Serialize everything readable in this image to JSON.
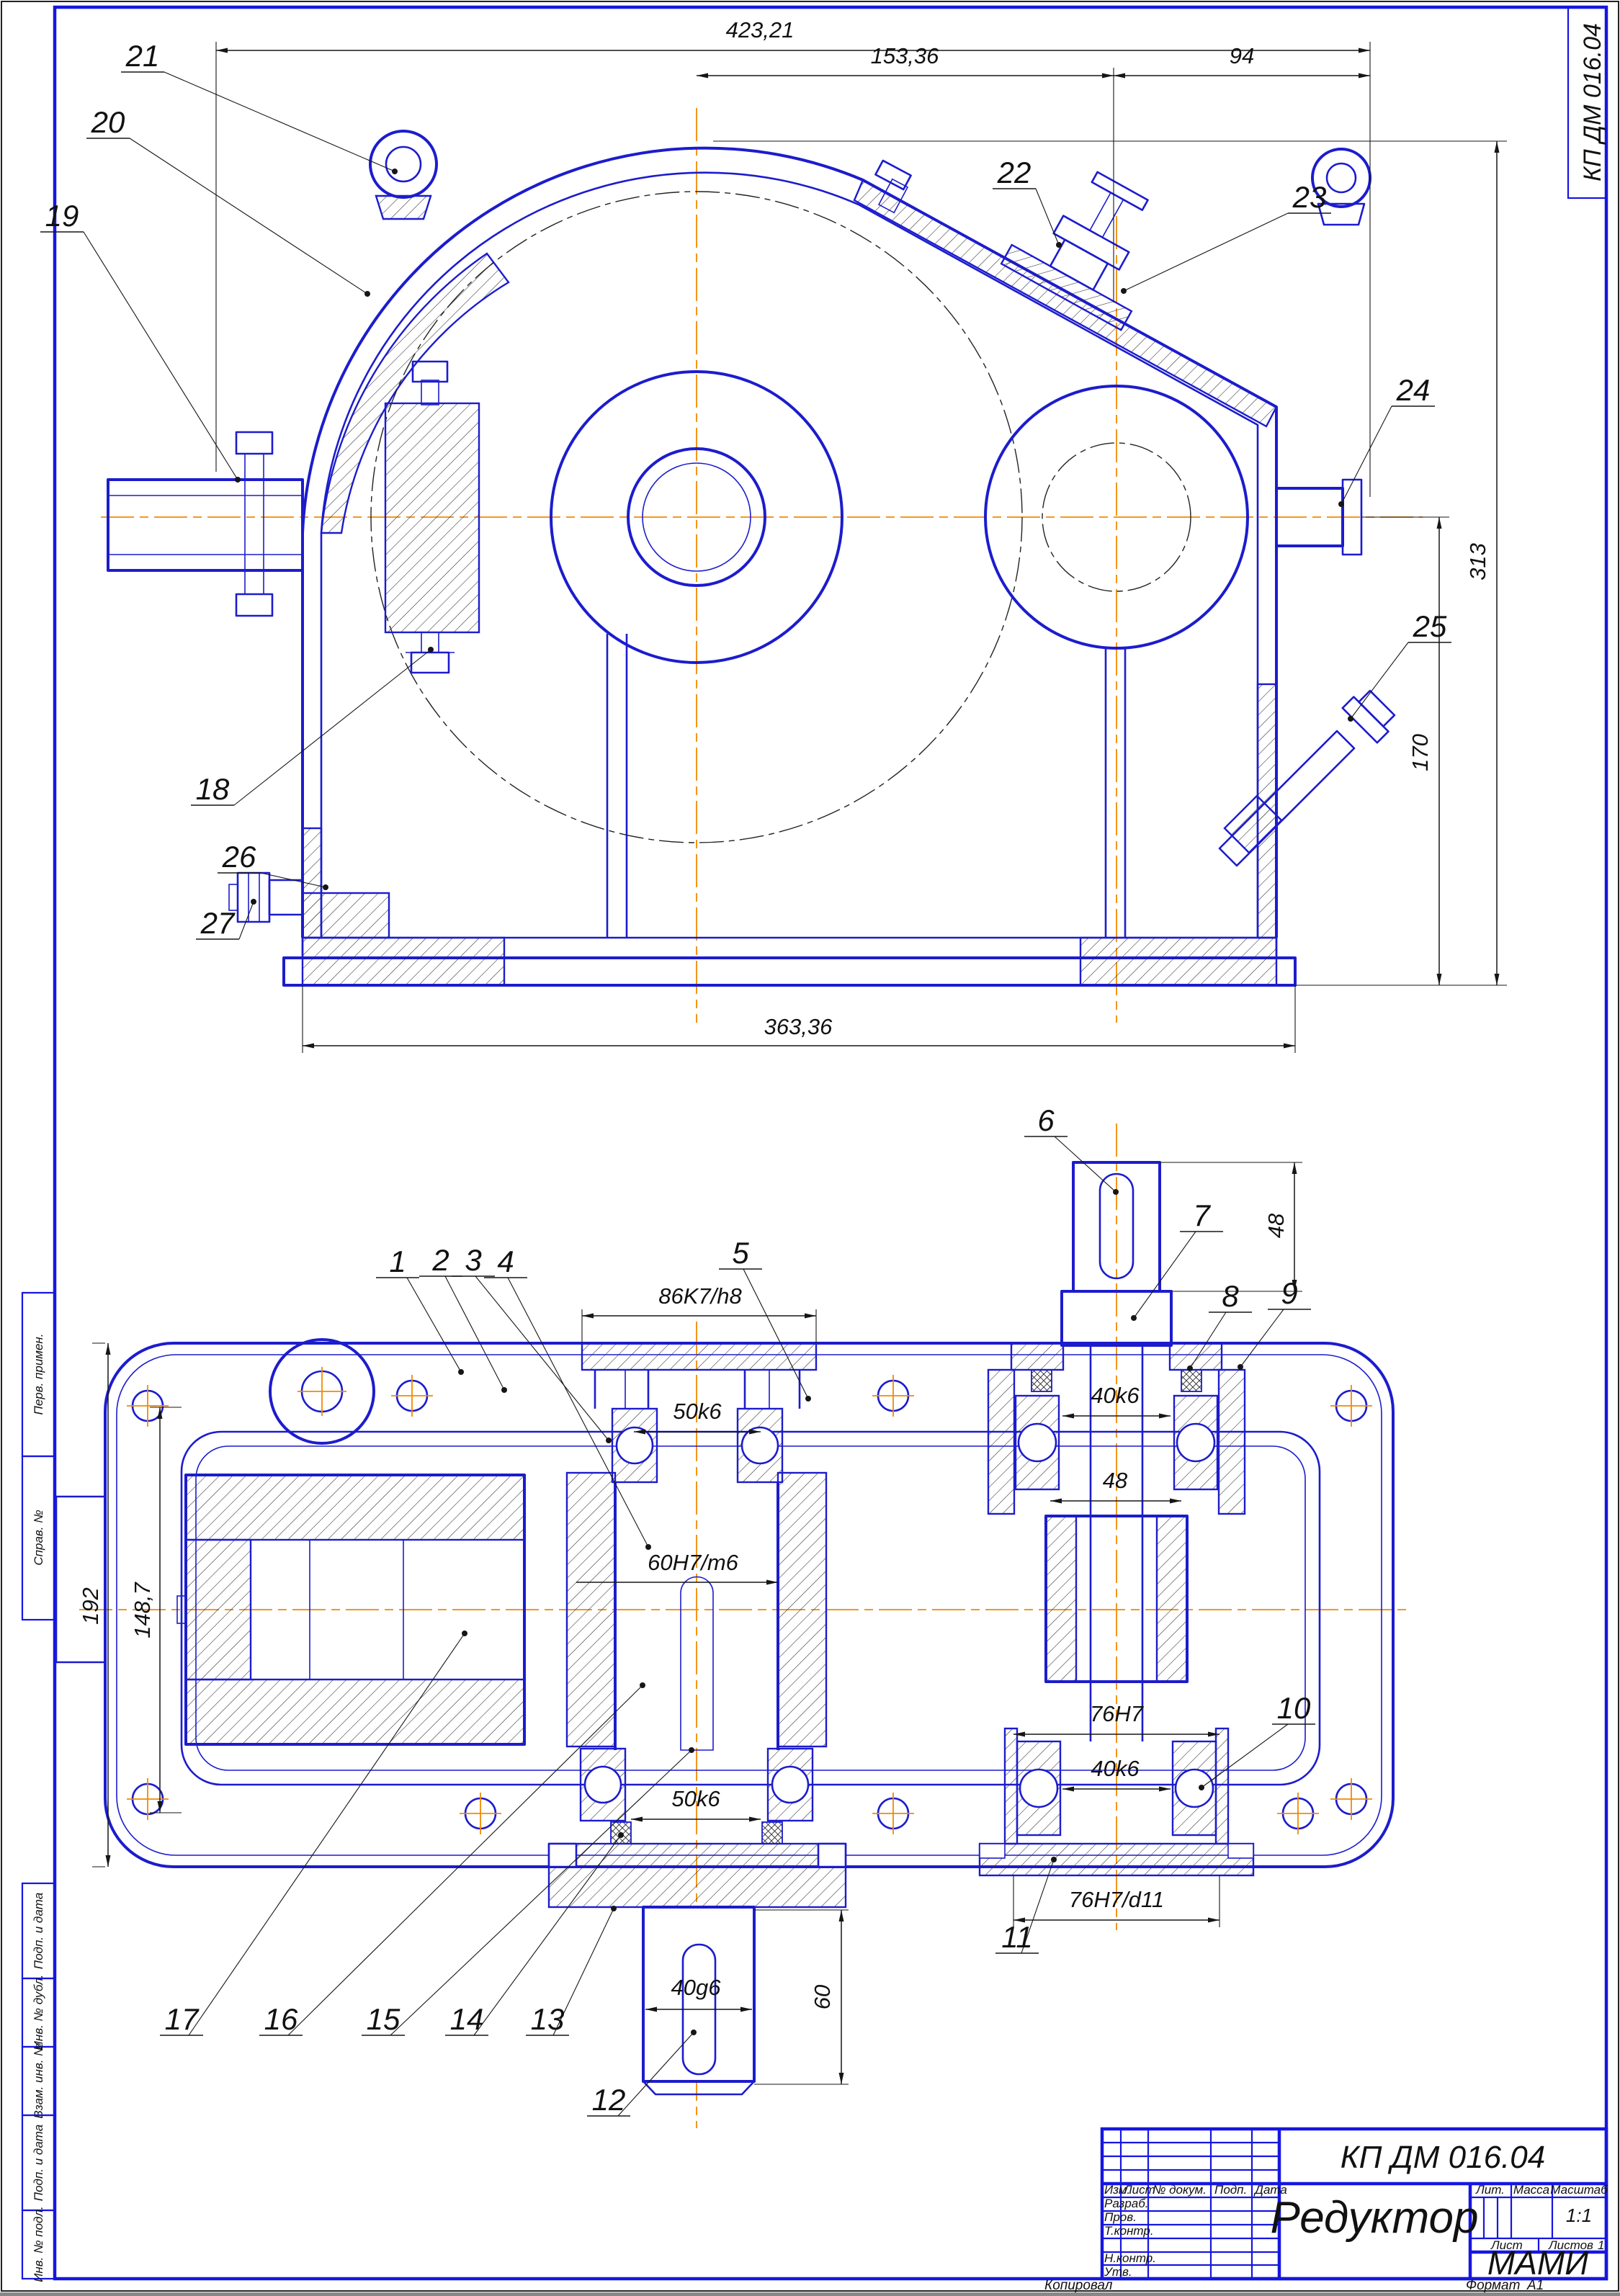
{
  "colors": {
    "line_blue": "#1c1ccd",
    "centerline_orange": "#f28a00",
    "dim_black": "#161616"
  },
  "page": {
    "copied_label": "Копировал",
    "format_label": "Формат",
    "format_value": "А1"
  },
  "frame": {
    "corner_stamp": "КП ДМ 016.04",
    "left_boxes": [
      {
        "label": "Перв. примен."
      },
      {
        "label": "Справ. №"
      },
      {
        "label": "Подп. и дата"
      },
      {
        "label": "Инв. № дубл."
      },
      {
        "label": "Взам. инв. №"
      },
      {
        "label": "Подп. и дата"
      },
      {
        "label": "Инв. № подл."
      }
    ]
  },
  "title_block": {
    "doc_number": "КП ДМ 016.04",
    "product_title": "Редуктор",
    "organization": "МАМИ",
    "scale_value": "1:1",
    "sheets_value": "1",
    "labels": {
      "izm": "Изм.",
      "list": "Лист",
      "doc_num": "№ докум.",
      "podp": "Подп.",
      "date": "Дата",
      "razrab": "Разраб.",
      "prov": "Пров.",
      "tkontr": "Т.контр.",
      "nkontr": "Н.контр.",
      "utv": "Утв.",
      "lit": "Лит.",
      "massa": "Масса",
      "masshtab": "Масштаб",
      "list2": "Лист",
      "listov": "Листов"
    }
  },
  "front_view": {
    "dimensions": {
      "overall_width": "423,21",
      "axis_to_right": "153,36",
      "right_offset": "94",
      "overall_height": "313",
      "axis_height": "170",
      "base_width": "363,36"
    },
    "callouts": [
      {
        "n": "21"
      },
      {
        "n": "20"
      },
      {
        "n": "19"
      },
      {
        "n": "18"
      },
      {
        "n": "26"
      },
      {
        "n": "27"
      },
      {
        "n": "22"
      },
      {
        "n": "23"
      },
      {
        "n": "24"
      },
      {
        "n": "25"
      }
    ]
  },
  "plan_view": {
    "dimensions": {
      "cap_fit": "86K7/h8",
      "upper_bearing_seat": "50k6",
      "wheel_seat": "60H7/m6",
      "input_upper_bearing": "40k6",
      "bearing_span": "48",
      "shaft_end_length": "48",
      "cup_bore": "76H7",
      "input_lower_bearing": "40k6",
      "cup_fit": "76H7/d11",
      "lower_bearing_seat": "50k6",
      "output_shaft_end": "40g6",
      "output_end_length": "60",
      "overall_width_dim": "192",
      "inner_width_dim": "148,7"
    },
    "callouts": [
      {
        "n": "1"
      },
      {
        "n": "2"
      },
      {
        "n": "3"
      },
      {
        "n": "4"
      },
      {
        "n": "5"
      },
      {
        "n": "6"
      },
      {
        "n": "7"
      },
      {
        "n": "8"
      },
      {
        "n": "9"
      },
      {
        "n": "10"
      },
      {
        "n": "11"
      },
      {
        "n": "12"
      },
      {
        "n": "13"
      },
      {
        "n": "14"
      },
      {
        "n": "15"
      },
      {
        "n": "16"
      },
      {
        "n": "17"
      }
    ]
  }
}
